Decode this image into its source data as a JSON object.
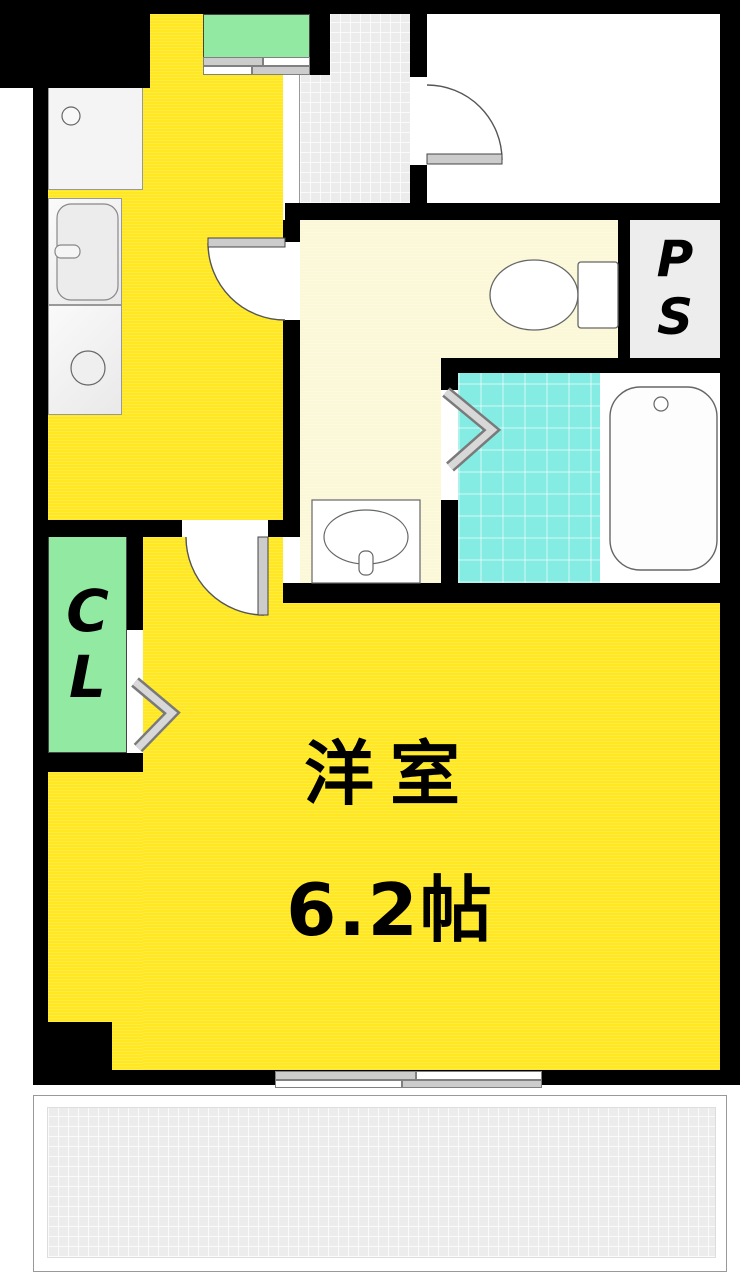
{
  "plan": {
    "type": "apartment-floorplan",
    "main_room": {
      "name_jp": "洋室",
      "area_text": "6.2帖",
      "area_jo": 6.2
    },
    "closet": {
      "abbr": "CL",
      "letters": [
        "C",
        "L"
      ]
    },
    "pipe_space": {
      "abbr": "PS",
      "letters": [
        "P",
        "S"
      ]
    },
    "fixtures": [
      "washing-machine-pan",
      "kitchen-sink",
      "stove-burner",
      "storage-cabinet",
      "toilet",
      "wash-basin",
      "bathtub"
    ],
    "doors": [
      "entrance-swing-door",
      "kitchen-swing-door",
      "main-room-swing-door",
      "closet-folding-door",
      "bathroom-folding-door",
      "storage-sliding-door",
      "balcony-sliding-window"
    ],
    "colors": {
      "room_yellow": "#ffe822",
      "hall_cream": "#fbf8d8",
      "bath_cyan": "#85ece4",
      "closet_green": "#92e9a2",
      "wall_black": "#000000",
      "ps_gray": "#ededed",
      "floor_texture_gray": "#ececec"
    }
  }
}
